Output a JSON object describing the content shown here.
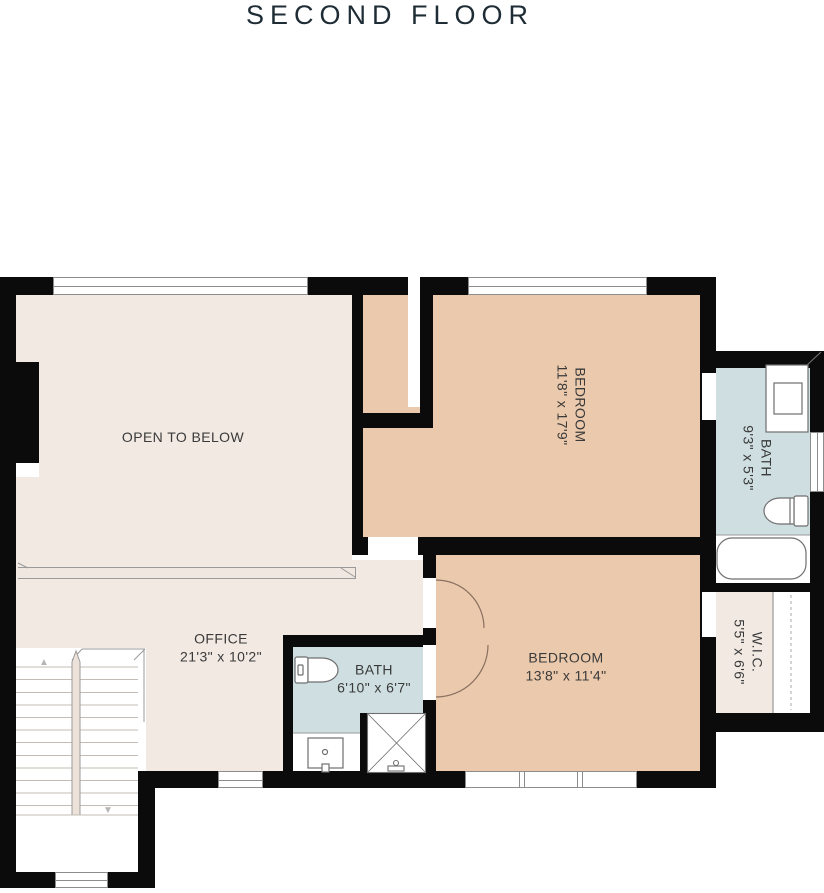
{
  "title": "SECOND FLOOR",
  "rooms": {
    "open_to_below": {
      "name": "OPEN TO BELOW"
    },
    "bedroom_top": {
      "name": "BEDROOM",
      "dims": "11'8\" x 17'9\""
    },
    "bath_right": {
      "name": "BATH",
      "dims": "9'3\" x 5'3\""
    },
    "wic": {
      "name": "W.I.C.",
      "dims": "5'5\" x 6'6\""
    },
    "office": {
      "name": "OFFICE",
      "dims": "21'3\" x 10'2\""
    },
    "bath_middle": {
      "name": "BATH",
      "dims": "6'10\" x 6'7\""
    },
    "bedroom_bottom": {
      "name": "BEDROOM",
      "dims": "13'8\" x 11'4\""
    }
  },
  "stairs": {
    "up_arrow": "▲",
    "down_arrow": "▼"
  },
  "colors": {
    "wall": "#0b0b0b",
    "floor_cream": "#f2e9e3",
    "floor_bedroom": "#ebc9ac",
    "floor_bath": "#cfdfe1",
    "title_text": "#1e2c35",
    "label_text": "#3a3a3a"
  }
}
